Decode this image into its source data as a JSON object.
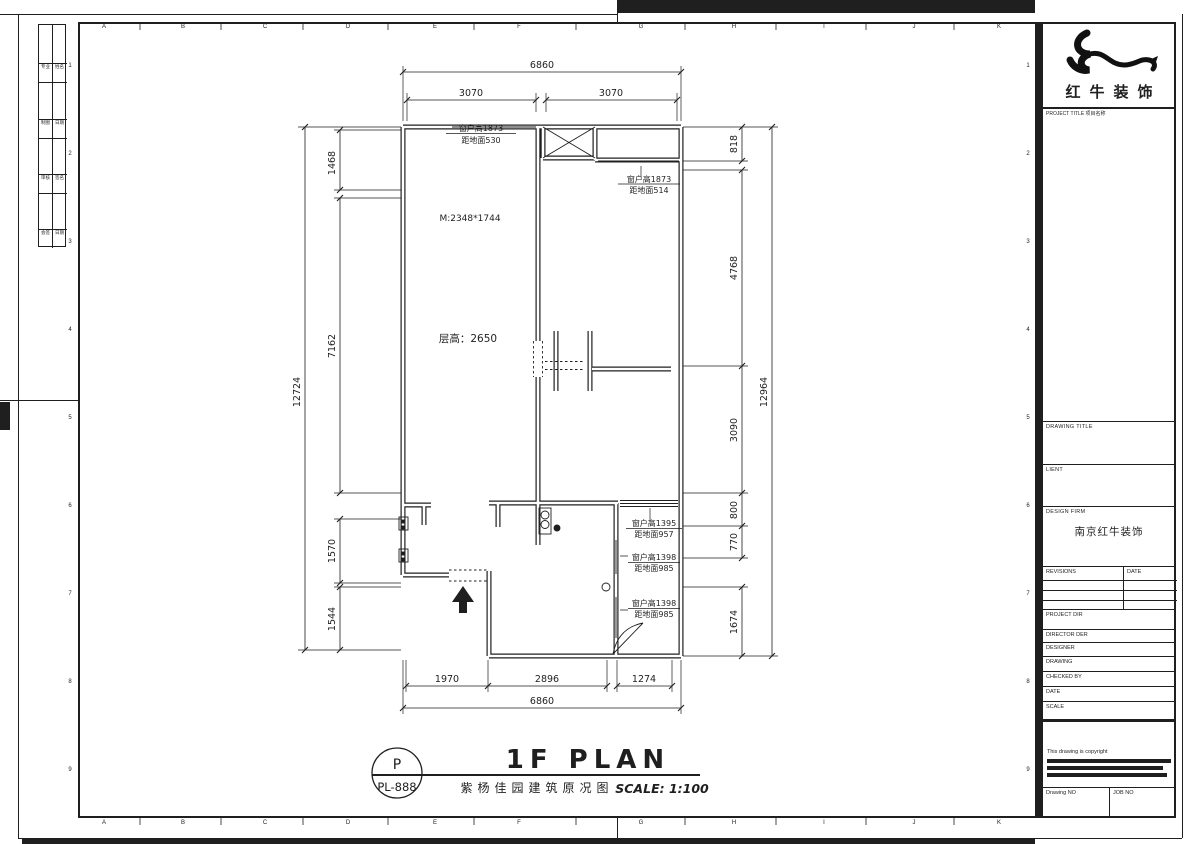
{
  "grid": {
    "letters": [
      "A",
      "B",
      "C",
      "D",
      "E",
      "F",
      "G",
      "H",
      "I",
      "J",
      "K"
    ],
    "numbers": [
      "1",
      "2",
      "3",
      "4",
      "5",
      "6",
      "7",
      "8",
      "9"
    ]
  },
  "signatures": {
    "cells": [
      "专业",
      "姓名",
      "制图",
      "日期",
      "审核",
      "签名",
      "会签",
      "日期"
    ]
  },
  "plan": {
    "notes": {
      "m_size": "M:2348*1744",
      "ceiling": "层高：2650"
    },
    "windows": [
      {
        "h": "窗户高1873",
        "d": "距地面530"
      },
      {
        "h": "窗户高1873",
        "d": "距地面514"
      },
      {
        "h": "窗户高1395",
        "d": "距地面957"
      },
      {
        "h": "窗户高1398",
        "d": "距地面985"
      },
      {
        "h": "窗户高1398",
        "d": "距地面985"
      }
    ],
    "dims": {
      "top_overall": "6860",
      "top_segs": [
        "3070",
        "3070"
      ],
      "bottom_segs": [
        "1970",
        "2896",
        "1274"
      ],
      "bottom_overall": "6860",
      "left_overall": "12724",
      "left_segs": [
        "1468",
        "7162",
        "1570",
        "1544"
      ],
      "right_segs": [
        "818",
        "4768",
        "3090",
        "800",
        "770",
        "1674"
      ],
      "right_overall": "12964"
    }
  },
  "titlebar": {
    "stamp_letter": "P",
    "stamp_code": "PL-888",
    "name": "1F PLAN",
    "cn": "紫杨佳园建筑原况图",
    "scale": "SCALE: 1:100"
  },
  "titleblock": {
    "company": "红牛装饰",
    "project_label": "PROJECT TITLE 项目名称",
    "drawing_label": "DRAWING TITLE",
    "client_label": "LIENT",
    "firm_label": "DESIGN FIRM",
    "firm_value": "南京红牛装饰",
    "rev_label": "REVISIONS",
    "rev_date_label": "DATE",
    "fields": [
      "PROJECT DIR",
      "DIRECTOR DER",
      "DESIGNER",
      "DRAWING",
      "CHECKED BY",
      "DATE",
      "SCALE"
    ],
    "copyright": "This drawing is copyright",
    "drawing_no_label": "Drawing NO",
    "job_no_label": "JOB NO"
  }
}
